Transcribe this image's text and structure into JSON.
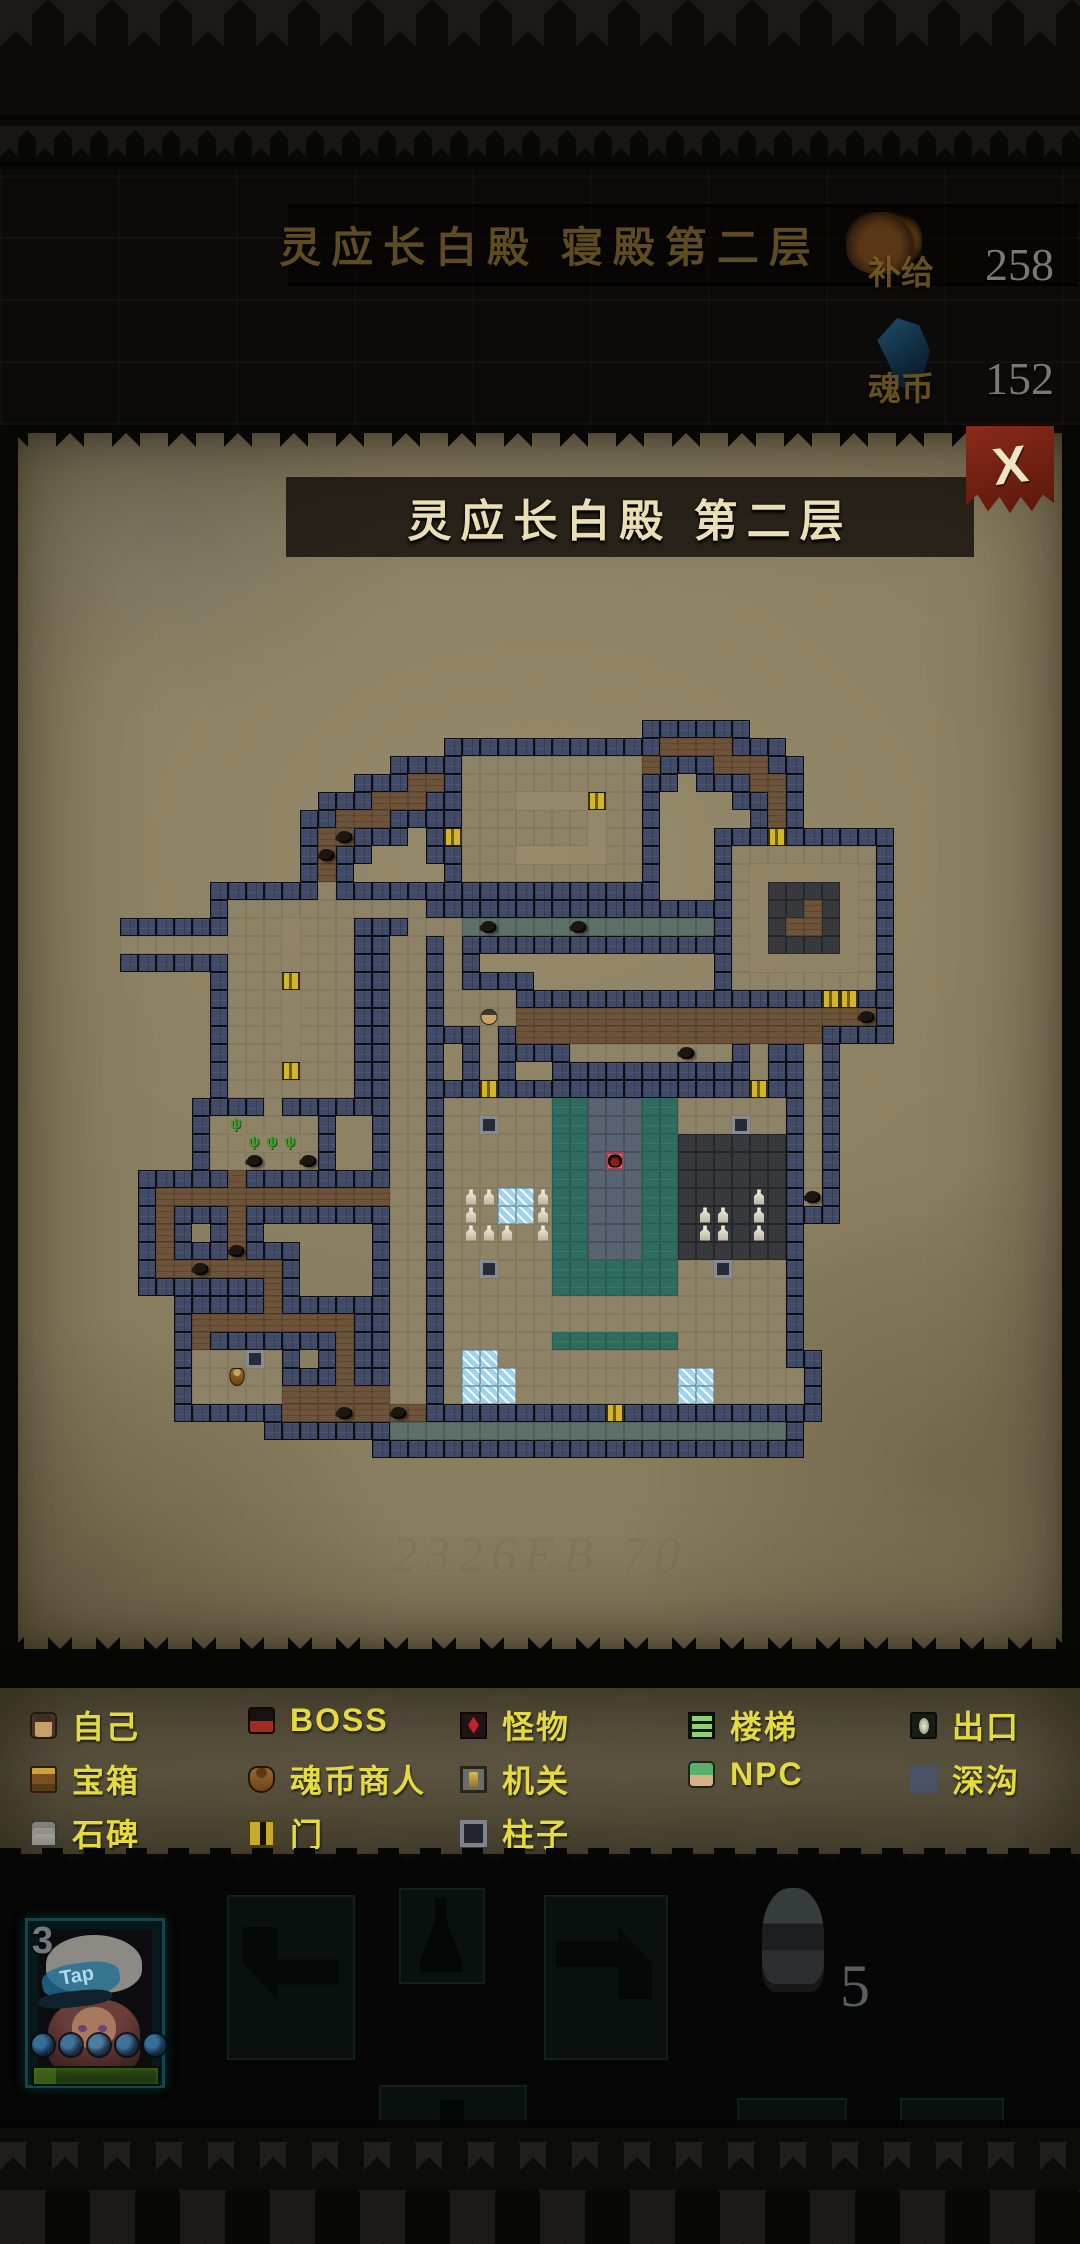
{
  "hud": {
    "location_title": "灵应长白殿 寝殿第二层",
    "supplies_label": "补给",
    "supplies_value": "258",
    "soul_label": "魂币",
    "soul_value": "152"
  },
  "map_panel": {
    "title": "灵应长白殿 第二层",
    "close_glyph": "X",
    "watermark": "2326EB 70"
  },
  "legend": {
    "rows": [
      [
        {
          "id": "self",
          "label": "自己"
        },
        {
          "id": "boss",
          "label": "BOSS"
        },
        {
          "id": "monster",
          "label": "怪物"
        },
        {
          "id": "stairs",
          "label": "楼梯"
        },
        {
          "id": "exit",
          "label": "出口"
        }
      ],
      [
        {
          "id": "chest",
          "label": "宝箱"
        },
        {
          "id": "merchant",
          "label": "魂币商人"
        },
        {
          "id": "mechanism",
          "label": "机关"
        },
        {
          "id": "npc",
          "label": "NPC"
        },
        {
          "id": "ditch",
          "label": "深沟"
        }
      ],
      [
        {
          "id": "stele",
          "label": "石碑"
        },
        {
          "id": "door",
          "label": "门"
        },
        {
          "id": "pillar",
          "label": "柱子"
        }
      ]
    ],
    "col_x": [
      30,
      248,
      460,
      688,
      910
    ],
    "row_y": [
      14,
      68,
      122
    ]
  },
  "map_grid": {
    "tile": 18,
    "origin_x": 120,
    "origin_y": 648,
    "cols": 46,
    "legend_key": {
      ".": "parchment",
      "#": "wall",
      "t": "tan-floor",
      "b": "brown-floor",
      "T": "teal-floor",
      "s": "stone-column",
      "g": "gray-corridor",
      "d": "dark-pit",
      "D": "door",
      "I": "ice",
      "G": "grass",
      "X": "boss-tile",
      "p": "pillar"
    },
    "rows": [
      "..............................................",
      "..............................................",
      "..............................................",
      "..............................................",
      "..............................................",
      "..............................bbbb............",
      "...................ttttttttttb...bbb..........",
      "................bb.tttttttttt......bb.........",
      "..............bbb..ttt####Dtt.......b.........",
      "............bbb....ttttttt#tt.......b.........",
      "...........bb.....Dttttttt#tt.......D.........",
      "...........b.......ttt#####tt.....tttttttt....",
      "...........b.......tttttttttt.....t######t....",
      "...........t......................t#dddd#t....",
      "......ttttttttttt.................t#ddbd#t....",
      "......ttt#ttt...tttgggggggggggggg.t#dbbd#t....",
      "ttttttttt#ttt..tt.t...............t#dddd#t....",
      "......ttt#ttt..tt.t...............t######t....",
      "......tttDttt..tt.t...............tttttttt....",
      "......ttt#ttt..tt.tttt.................DD.....",
      "......ttt#ttt..tt.ttttbbbbbbbbbbbbbbbbbbbb....",
      "......ttt#ttt..tt...t.bbbbbbbbbbbbbbbbb.......",
      "......ttt#ttt..tt...t....ttttttttt.t..t.......",
      "......tttDttt..tt...t..............t..t.......",
      "......ttttttt..tt...D..............D..t.......",
      "........t......tt.ttttttTTsssTTtttttt.t.......",
      ".....tGtttt....tt.ttptttTTsssTTtttptt.t.......",
      ".....ttGGGt....tt.ttttttTTsssTTdddddd.t.......",
      ".....tttttt....tt.ttttttTTsXsTTdddddd.t.......",
      "......b........tt.ttttttTTsssTTdddddd.t.......",
      "..bbbbbbbbbbbbbtt.tttIItTTsssTTdddddd.t.......",
      "..b...b........tt.tttIItTTsssTTdddddd.........",
      "..b...b........tt.ttttttTTsssTTdddddd.........",
      "..b...b........tt.ttttttTTsssTTdddddd.........",
      "..bbbbbbb......tt.ttptttTTTTTTTttpttt.........",
      "........b......tt.ttttttTTTTTTTtttttt.........",
      "........b......tt.ttttttttttttttttttt.........",
      "....bbbbbbbbb..tt.ttttttttttttttttttt.........",
      "....b.......b..tt.ttttttTTTTTTTtttttt.........",
      "....tttpt...b..tt.tIItttttttttttttttt.........",
      "....ttttt...b..tt.tIIItttttttttIIttttt........",
      "....tttttbbbbbbtt.tIIItttttttttIIttttt........",
      ".........bbbbbbbb..........D..................",
      "...............gggggggggggggggggggggg.........",
      ".............................................."
    ]
  },
  "map_icons": [
    {
      "type": "monster",
      "c": 12,
      "r": 10
    },
    {
      "type": "monster",
      "c": 11,
      "r": 11
    },
    {
      "type": "monster",
      "c": 20,
      "r": 15
    },
    {
      "type": "monster",
      "c": 25,
      "r": 15
    },
    {
      "type": "monster",
      "c": 31,
      "r": 22
    },
    {
      "type": "monster",
      "c": 41,
      "r": 20
    },
    {
      "type": "monster",
      "c": 38,
      "r": 30
    },
    {
      "type": "monster",
      "c": 7,
      "r": 28
    },
    {
      "type": "monster",
      "c": 10,
      "r": 28
    },
    {
      "type": "monster",
      "c": 6,
      "r": 33
    },
    {
      "type": "monster",
      "c": 4,
      "r": 34
    },
    {
      "type": "monster",
      "c": 12,
      "r": 42
    },
    {
      "type": "monster",
      "c": 15,
      "r": 42
    },
    {
      "type": "statue",
      "c": 19,
      "r": 30
    },
    {
      "type": "statue",
      "c": 20,
      "r": 30
    },
    {
      "type": "statue",
      "c": 23,
      "r": 30
    },
    {
      "type": "statue",
      "c": 19,
      "r": 31
    },
    {
      "type": "statue",
      "c": 23,
      "r": 31
    },
    {
      "type": "statue",
      "c": 19,
      "r": 32
    },
    {
      "type": "statue",
      "c": 20,
      "r": 32
    },
    {
      "type": "statue",
      "c": 21,
      "r": 32
    },
    {
      "type": "statue",
      "c": 23,
      "r": 32
    },
    {
      "type": "statue",
      "c": 35,
      "r": 30
    },
    {
      "type": "statue",
      "c": 32,
      "r": 31
    },
    {
      "type": "statue",
      "c": 33,
      "r": 31
    },
    {
      "type": "statue",
      "c": 35,
      "r": 31
    },
    {
      "type": "statue",
      "c": 32,
      "r": 32
    },
    {
      "type": "statue",
      "c": 33,
      "r": 32
    },
    {
      "type": "statue",
      "c": 35,
      "r": 32
    },
    {
      "type": "player",
      "c": 20,
      "r": 20
    },
    {
      "type": "boss",
      "c": 27,
      "r": 28
    },
    {
      "type": "merchant",
      "c": 6,
      "r": 40
    }
  ],
  "bottom": {
    "card_count": "3",
    "cap_text": "Tap",
    "ammo_count": "5"
  }
}
